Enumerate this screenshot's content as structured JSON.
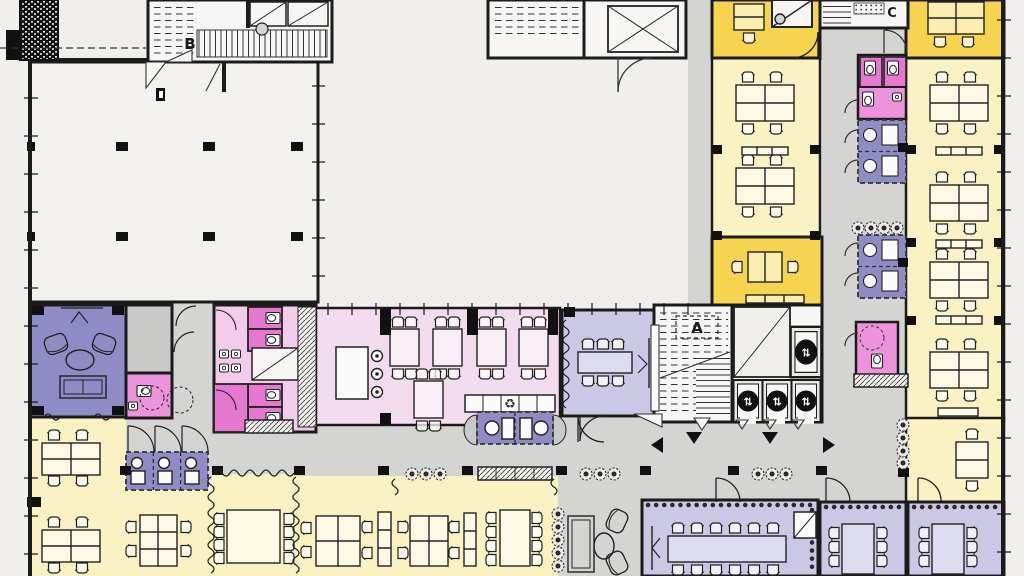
{
  "plan": {
    "type": "architectural-floor-plan",
    "stairs": {
      "a": "A",
      "b": "B",
      "c": "C"
    },
    "icons": {
      "elevator_glyph": "⇅",
      "recycle_glyph": "♻",
      "elevator_icon": "elevator-up-down-arrows",
      "recycle_icon": "recycling-symbol",
      "plant_icon": "potted-plant",
      "direction_markers": "solid-triangle-arrows"
    },
    "palette": {
      "open_office": "#faf2c3",
      "enclosed_room": "#f6d44f",
      "meeting_room": "#cbc8e6",
      "lounge_focus": "#8f8bc5",
      "cafeteria": "#f3dcee",
      "sanitary": "#ec93dc",
      "sanitary_stall": "#e678d0",
      "circulation": "#d4d4d2",
      "storage_gray": "#c9c9c7",
      "core_white": "#f7f6f4",
      "hall_white": "#f2f1ee",
      "wall": "#1b1b1b",
      "background": "#f0efec"
    }
  }
}
